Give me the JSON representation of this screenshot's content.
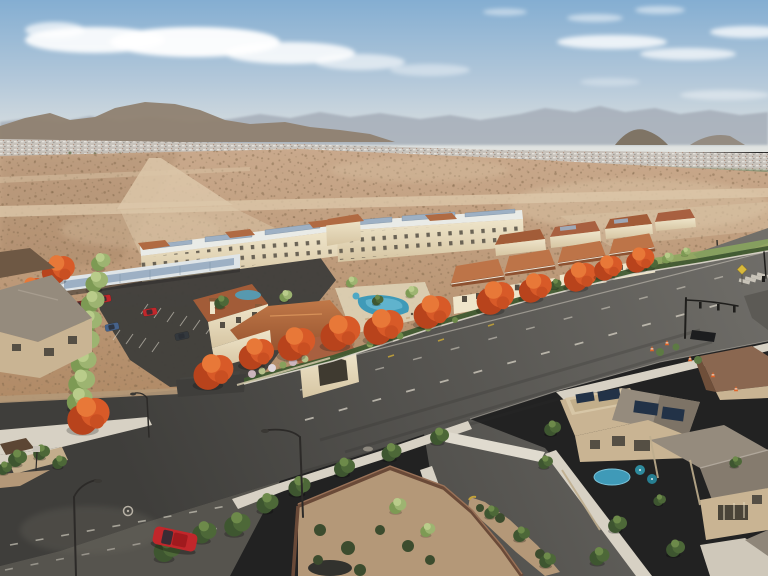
{
  "scene": {
    "type": "aerial-architectural-rendering",
    "description": "Aerial composite photo: rendered apartment community with terracotta roofs, solar carports, pool and bright orange street trees on vacant desert land, beside an existing suburban neighborhood with rooftop solar, wide new asphalt streets and a signalized intersection; hazy mountains and distant rooftops on the horizon."
  },
  "landscape": {
    "sky": "clear blue with thin wispy clouds",
    "mountains": "hazy gray-blue ranges with brown foreground hills",
    "horizon_band": "distant suburban rooftops with tree line",
    "terrain": "scrub desert crossed by light dirt roads"
  },
  "complex": {
    "apartment_buildings": "three-story cream buildings, flat white roofs with solar arrays and terracotta hip accents",
    "townhomes_front_row": 4,
    "townhomes_back_row": 4,
    "clubhouse": "terracotta-roof clubhouse with arched window and two chimneys",
    "pool": "curved blue pool with tan deck and loungers",
    "carports": "solar-panel covered parking canopies",
    "parking_cars": [
      "red",
      "maroon",
      "dark blue",
      "blue",
      "red",
      "dark gray"
    ],
    "orange_street_trees": 15,
    "green_screen_trees": 9
  },
  "streets": {
    "main_road": "wide fresh asphalt with dashed white lane lines and yellow bike-lane ticks",
    "intersection": "signal mast arm, crosswalk bars, orange traffic cones, yellow warning sign",
    "side_street": "older worn asphalt with faded dashes",
    "entrance_street": "gravel median island with trees and yellow curb tip",
    "moving_cars": [
      "red"
    ],
    "street_lights": 4,
    "manholes": 2
  },
  "neighborhood": {
    "houses": "two-story stucco homes, gray tile and flat parapet roofs with solar panels",
    "backyard": "small blue pool with teal umbrellas",
    "walled_yard": "brown block wall around gravel yard with shrubs"
  },
  "palette": {
    "sky_top": "#84aed2",
    "sky_mid": "#b5c9da",
    "sky_horizon": "#e2e4e1",
    "cloud": "#ffffff",
    "mountain_far": "#a6aeb9",
    "hill_brown": "#8f8170",
    "city_band": "#c8c3bc",
    "band_green": "#6d7d53",
    "desert_light": "#c9a98c",
    "desert_dark": "#b08a66",
    "dirt_road": "#dcc7a9",
    "asphalt_dark": "#3f3e3b",
    "asphalt_light": "#6f6d68",
    "old_asphalt": "#56544e",
    "sidewalk": "#d7d1c4",
    "curb": "#e2dcd0",
    "lane_white": "#cfcabe",
    "lane_yellow": "#c2a23a",
    "roof_terracotta": "#b06a42",
    "roof_terracotta_dark": "#96532f",
    "roof_flat_white": "#e9ebe7",
    "wall_cream": "#efe5ca",
    "wall_cream_shade": "#d6c5a2",
    "window_dark": "#554f44",
    "solar_panel": "#9db0c4",
    "solar_dark": "#223247",
    "tree_orange": "#d85a28",
    "tree_orange_dark": "#b8431c",
    "tree_orange_light": "#e87838",
    "tree_green_light": "#9db471",
    "tree_green_dark": "#4d6838",
    "hedge_green": "#3f5a30",
    "grass_green": "#8aa85e",
    "pool_blue": "#3f9ab8",
    "pool_light": "#7cc8de",
    "car_red": "#c1272b",
    "gravel": "#b49878",
    "wall_brown": "#6a4a38",
    "house_tan": "#c9b493",
    "house_roof_gray": "#958b7d",
    "cone_orange": "#e06428",
    "signal_black": "#1f1e1c"
  }
}
